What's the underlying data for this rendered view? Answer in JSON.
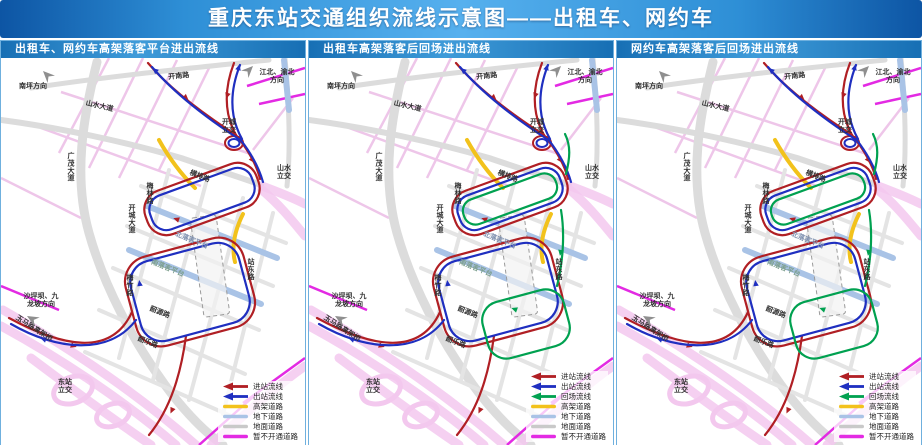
{
  "title": "重庆东站交通组织流线示意图——出租车、网约车",
  "colors": {
    "flows": {
      "inbound": "#b01f24",
      "outbound": "#1f2fc0",
      "return": "#00a150"
    },
    "roads": {
      "elevated": "#f2c21c",
      "underground": "#a9c3e6",
      "ground": "#c9c9c9",
      "closed": "#e32ae3"
    },
    "map": {
      "road_base": "#dcdcdc",
      "road_grid": "#e4e4e4",
      "road_pink": "#f3c8ee",
      "road_pink_thin": "#eec6e9",
      "label": "#2f2f2f",
      "platform_north_label": "#7d8fae",
      "platform_south_label": "#7d9f8e",
      "sign_arrow": "#8f8f8f"
    }
  },
  "legend_labels": {
    "inbound": "进站流线",
    "outbound": "出站流线",
    "return": "回场流线",
    "elevated": "高架道路",
    "underground": "地下道路",
    "ground": "地面道路",
    "closed": "暂不开通道路"
  },
  "panels": [
    {
      "header": "出租车、网约车高架落客平台进出流线",
      "flows": [
        "inbound",
        "outbound"
      ],
      "legend": [
        "inbound",
        "outbound",
        "elevated",
        "underground",
        "ground",
        "closed"
      ]
    },
    {
      "header": "出租车高架落客后回场进出流线",
      "flows": [
        "inbound",
        "outbound",
        "return"
      ],
      "legend": [
        "inbound",
        "outbound",
        "return",
        "elevated",
        "underground",
        "ground",
        "closed"
      ]
    },
    {
      "header": "网约车高架落客后回场进出流线",
      "flows": [
        "inbound",
        "outbound",
        "return"
      ],
      "legend": [
        "inbound",
        "outbound",
        "return",
        "elevated",
        "underground",
        "ground",
        "closed"
      ]
    }
  ],
  "map_labels": [
    {
      "id": "nanping-direction",
      "text": "南坪方向",
      "x": 32,
      "y": 30
    },
    {
      "id": "kainan-road",
      "text": "开南路",
      "x": 178,
      "y": 20,
      "rot": -6
    },
    {
      "id": "jiangbei-yubei-direction",
      "lines": [
        "江北、渝北",
        "方向"
      ],
      "x": 276,
      "y": 16
    },
    {
      "id": "shanshui-avenue",
      "text": "山水大道",
      "x": 98,
      "y": 50,
      "rot": 13
    },
    {
      "id": "kaicheng-interchange",
      "lines": [
        "开城",
        "立交"
      ],
      "x": 228,
      "y": 66
    },
    {
      "id": "guangmao-avenue",
      "text": "广茂大道",
      "x": 70,
      "y": 100,
      "orient": "v"
    },
    {
      "id": "hengpai-road",
      "text": "横排路",
      "x": 198,
      "y": 120,
      "rot": 22
    },
    {
      "id": "meilin-road",
      "text": "梅林路",
      "x": 149,
      "y": 130,
      "orient": "v"
    },
    {
      "id": "shanshui-interchange",
      "lines": [
        "山水",
        "立交"
      ],
      "x": 283,
      "y": 112
    },
    {
      "id": "kaicheng-avenue",
      "text": "开城大道",
      "x": 131,
      "y": 152,
      "orient": "v"
    },
    {
      "id": "north-dropoff-platform",
      "text": "北落客平台",
      "x": 190,
      "y": 184,
      "rot": 22,
      "color": "platform_north_label"
    },
    {
      "id": "south-dropoff-platform",
      "text": "南落客平台",
      "x": 166,
      "y": 212,
      "rot": 22,
      "color": "platform_south_label"
    },
    {
      "id": "meizhu-road",
      "text": "梅竹路",
      "x": 129,
      "y": 222,
      "orient": "v"
    },
    {
      "id": "zhandong-road",
      "text": "站东路",
      "x": 250,
      "y": 206,
      "orient": "v"
    },
    {
      "id": "shaoyuan-road",
      "text": "韶源路",
      "x": 158,
      "y": 256,
      "rot": 22
    },
    {
      "id": "shaole-road",
      "text": "韶乐路",
      "x": 146,
      "y": 286,
      "rot": 22
    },
    {
      "id": "shapingba-jiulongpo-direction",
      "lines": [
        "沙坪坝、九",
        "龙坡方向"
      ],
      "x": 40,
      "y": 240
    },
    {
      "id": "yuma-viaduct",
      "text": "玉马路高架桥",
      "x": 32,
      "y": 272,
      "rot": 33
    },
    {
      "id": "dongzhan-interchange",
      "lines": [
        "东站",
        "立交"
      ],
      "x": 64,
      "y": 326
    }
  ],
  "map_arrows": [
    {
      "id": "nanping-arrow",
      "x": 42,
      "y": 13,
      "rot": 45
    },
    {
      "id": "jiangbei-arrow",
      "x": 252,
      "y": 8,
      "rot": 135
    },
    {
      "id": "shapingba-arrow",
      "x": 26,
      "y": 258,
      "rot": 30
    }
  ]
}
